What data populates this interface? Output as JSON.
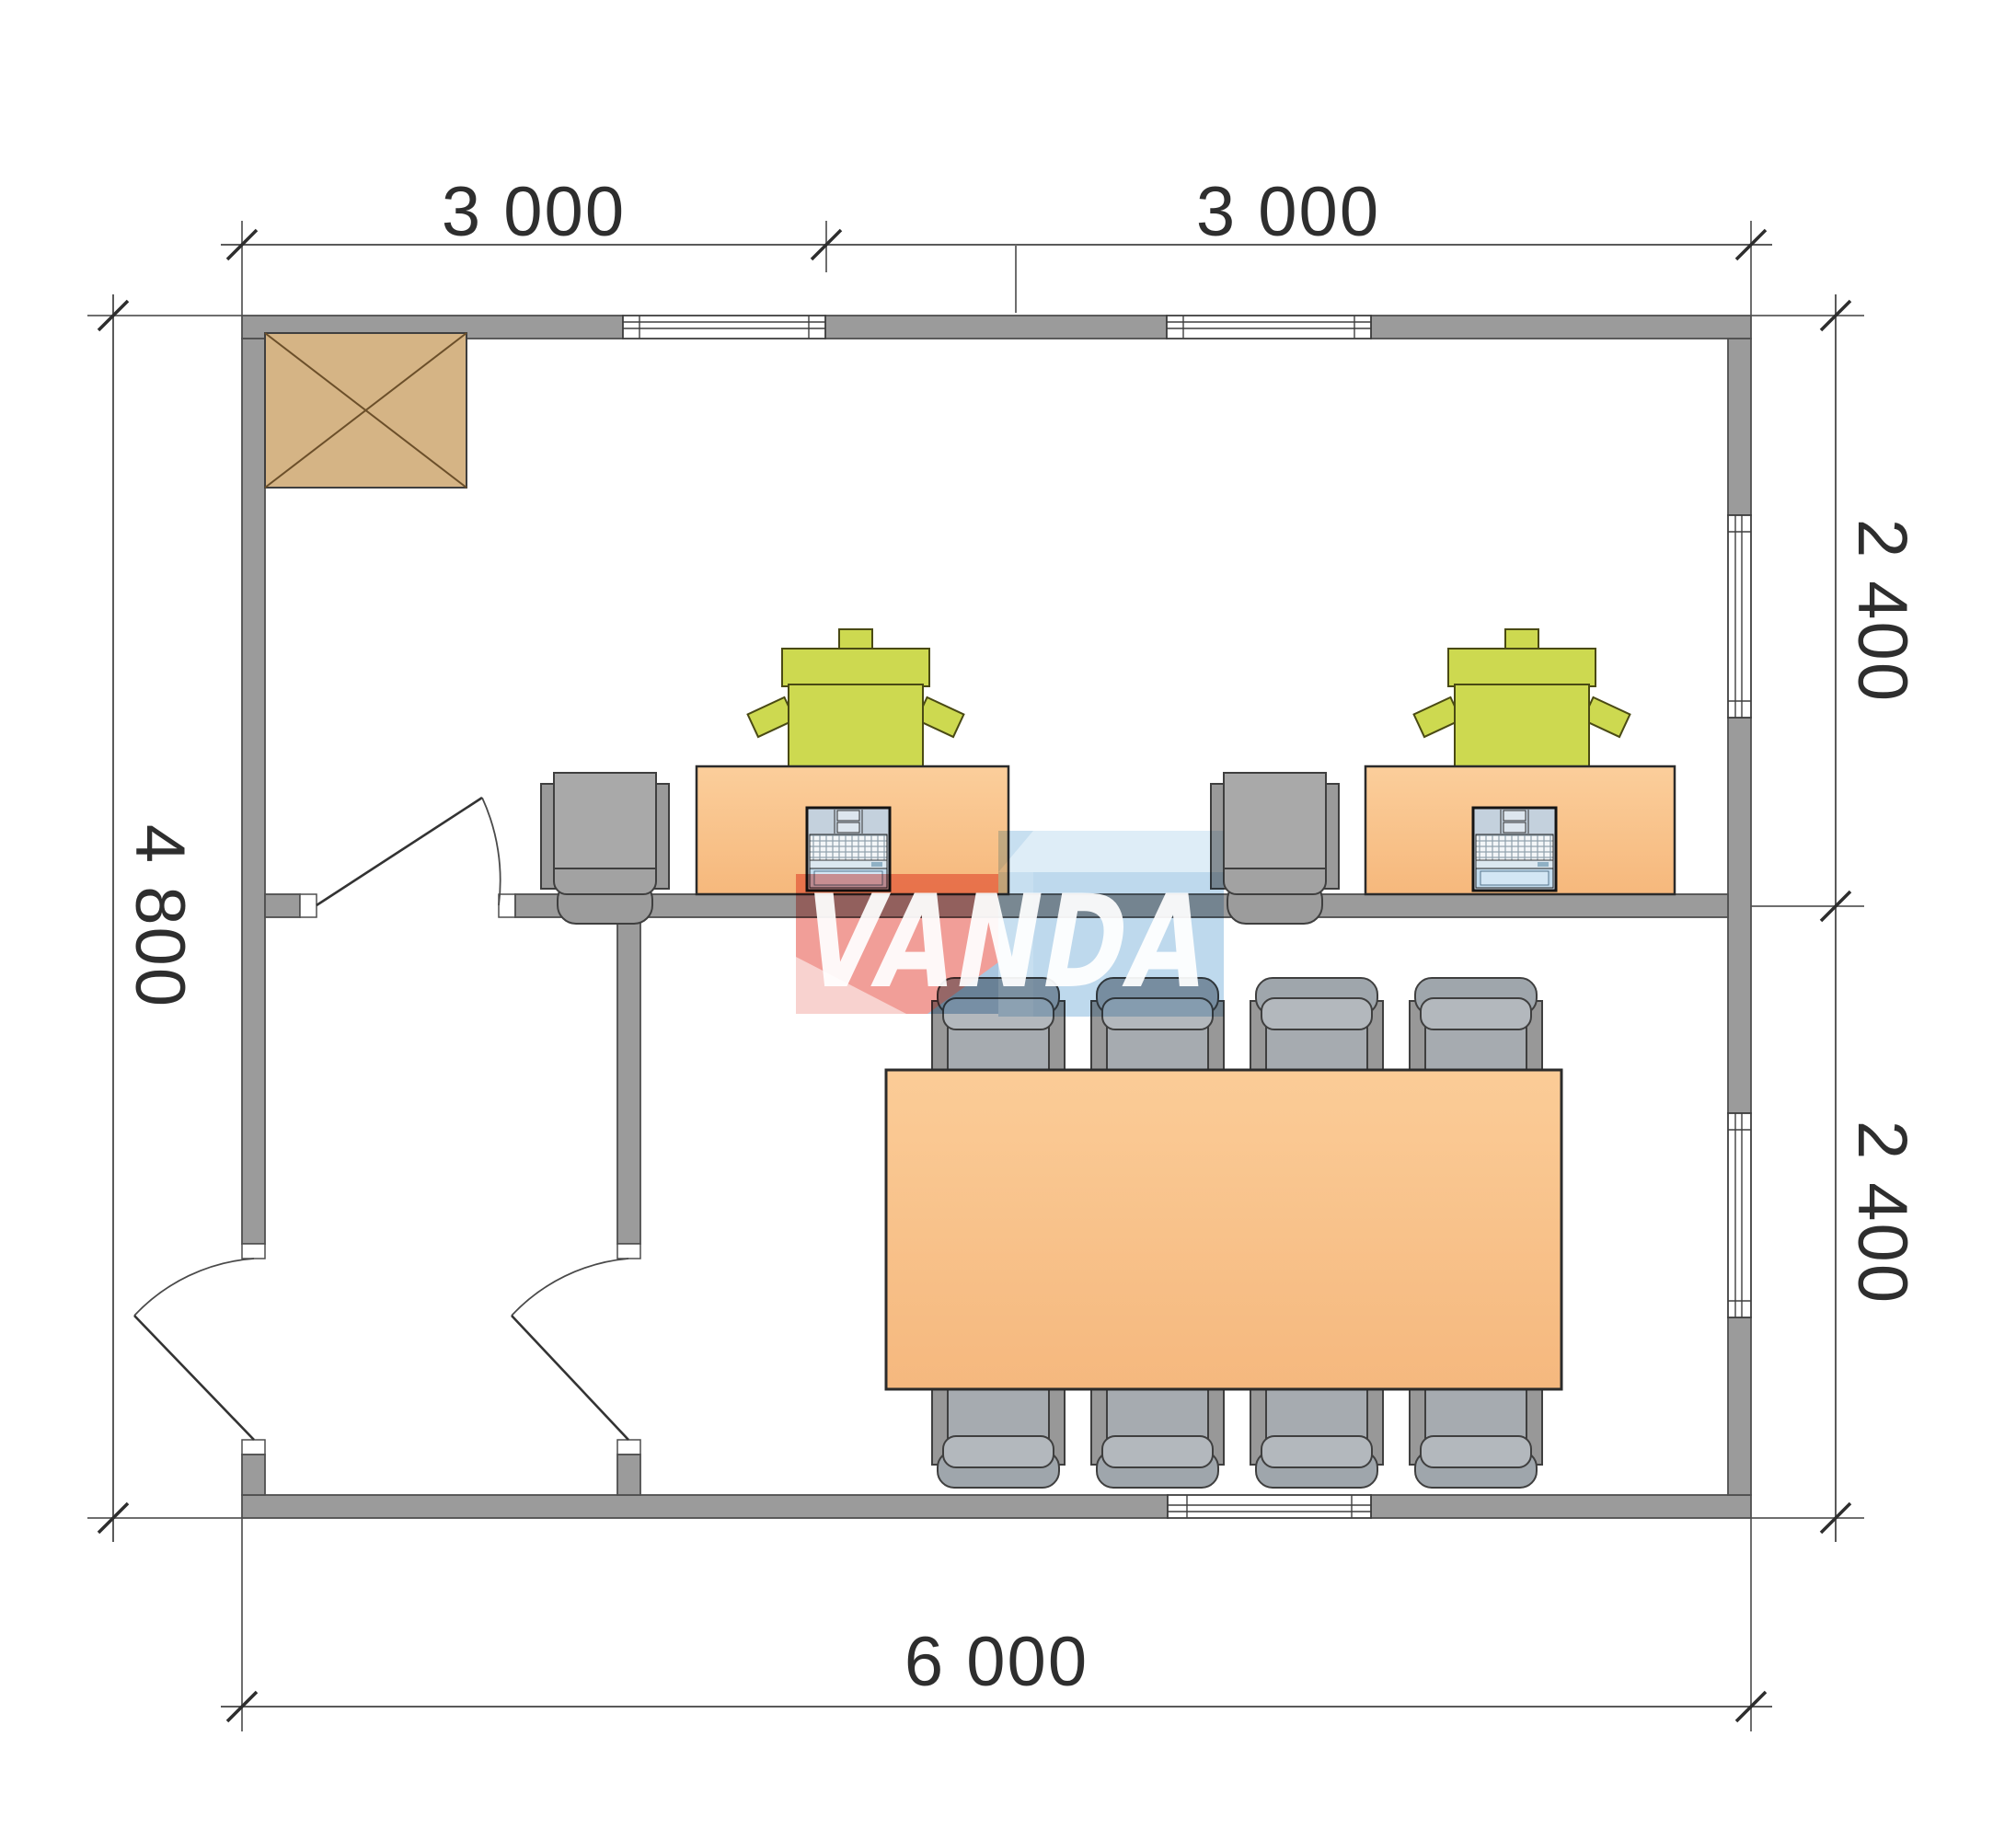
{
  "dimensions": {
    "top": {
      "labels": [
        "3 000",
        "3 000"
      ]
    },
    "right": {
      "labels": [
        "2 400",
        "2 400"
      ]
    },
    "left": {
      "label": "4 800"
    },
    "bottom": {
      "label": "6 000"
    }
  },
  "watermark": {
    "text": "VANDA"
  },
  "furniture": {
    "wardrobes": 1,
    "desks": 2,
    "laptops": 2,
    "desk_chairs_green": 2,
    "guest_chairs": 2,
    "meeting_tables": 1,
    "meeting_chairs": 8
  },
  "colors": {
    "background": "#ffffff",
    "wall": "#9b9b9b",
    "wall_outline": "#4f4f4f",
    "window": "#ffffff",
    "dimension": "#2e2e2e",
    "wardrobe": "#d5b485",
    "wardrobe_line": "#6b4f2a",
    "desk": "#f8c28a",
    "table": "#f7c189",
    "desk_chair_green": "#cdd950",
    "chair_gray": "#a9a9a9",
    "chair_meeting": "#a6abb0",
    "laptop_body": "#cdd9e5",
    "laptop_panel": "#c3dcee",
    "watermark_red": "#ef8b84",
    "watermark_pink": "#f7c9c6",
    "watermark_blue": "#bcd9ee",
    "watermark_blue_light": "#d8eaf6",
    "watermark_blue_face": "#b2d2ea",
    "watermark_blue_dark": "#98bbd9"
  }
}
